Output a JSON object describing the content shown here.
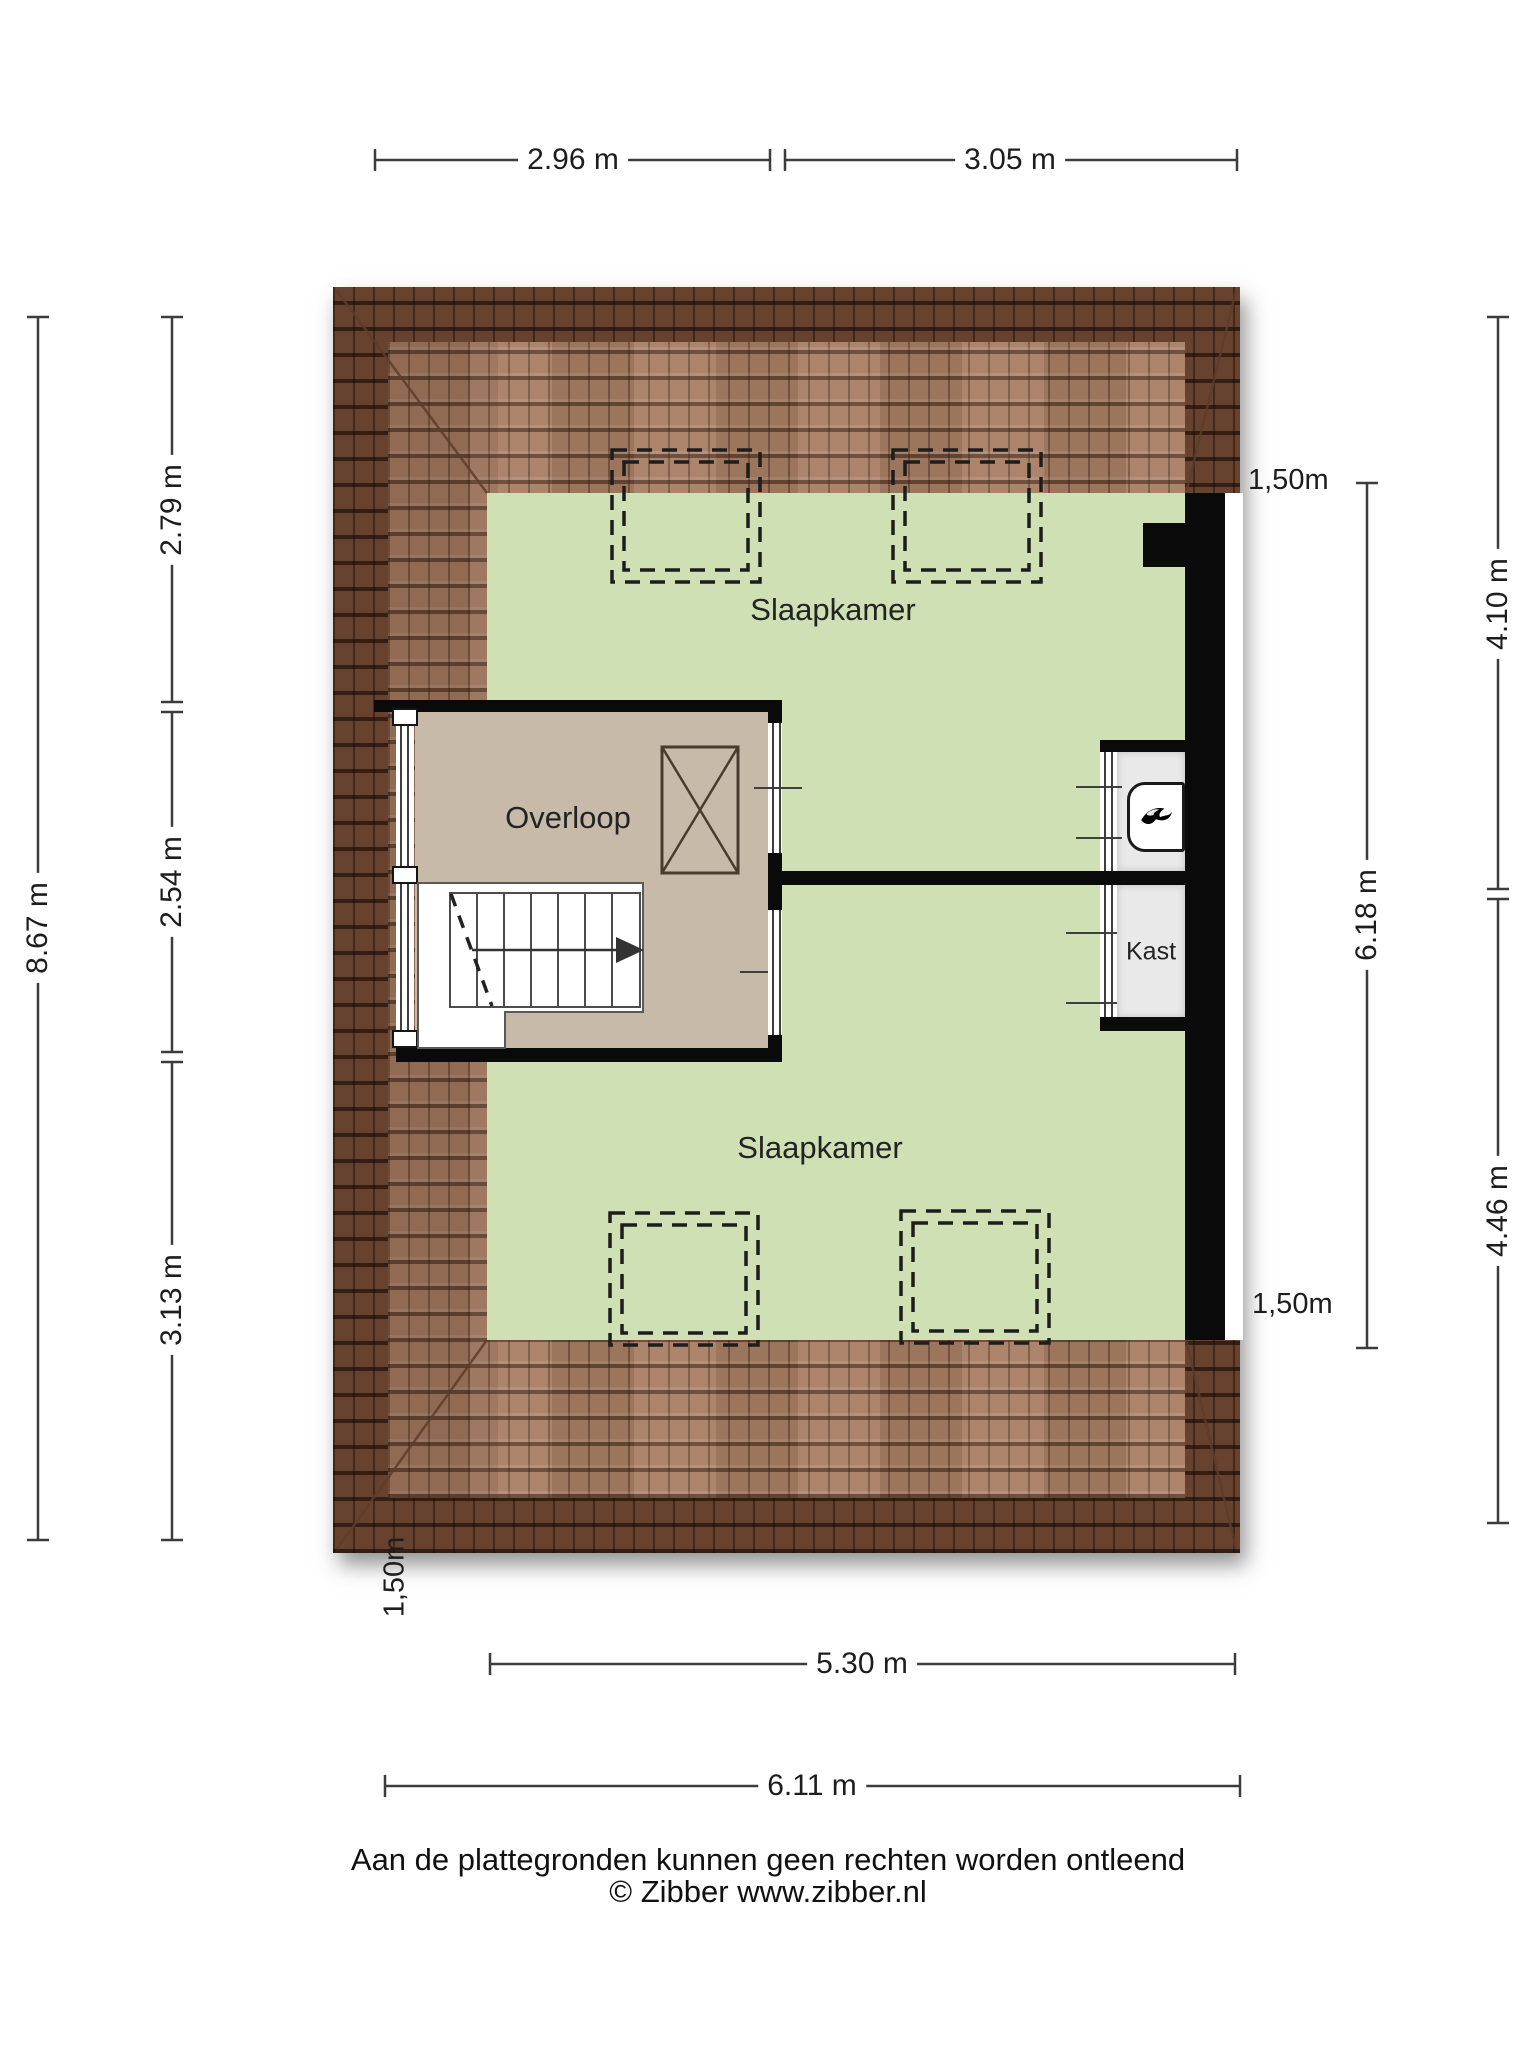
{
  "document": {
    "type": "floorplan",
    "provider_note": "Aan de plattegronden kunnen geen rechten worden ontleend",
    "copyright": "© Zibber www.zibber.nl"
  },
  "rooms": {
    "bedroom_top": {
      "label": "Slaapkamer"
    },
    "bedroom_bottom": {
      "label": "Slaapkamer"
    },
    "landing": {
      "label": "Overloop"
    },
    "closet": {
      "label": "Kast"
    }
  },
  "dimensions": {
    "top": {
      "d1": "2.96 m",
      "d2": "3.05 m"
    },
    "left": {
      "outer": "8.67 m",
      "s1": "2.79 m",
      "s2": "2.54 m",
      "s3": "3.13 m"
    },
    "right": {
      "inner": "6.18 m",
      "outer_top": "4.10 m",
      "outer_bottom": "4.46 m"
    },
    "bottom": {
      "inner": "5.30 m",
      "outer": "6.11 m"
    },
    "headroom_top_right": "1,50m",
    "headroom_bottom_right": "1,50m",
    "headroom_bottom_left": "1,50m"
  },
  "footer": {
    "disclaimer": "Aan de plattegronden kunnen geen rechten worden ontleend",
    "copyright": "© Zibber www.zibber.nl"
  },
  "icons": {
    "boiler": "flame-icon"
  },
  "colors": {
    "roof_dark": "#66422f",
    "roof_light": "#a87e64",
    "room_green": "#cee0b4",
    "landing_tan": "#c8baa8",
    "closet_gray": "#e9e9e9",
    "wall_black": "#0a0a0a",
    "dimension_line": "#3c3c3c"
  }
}
